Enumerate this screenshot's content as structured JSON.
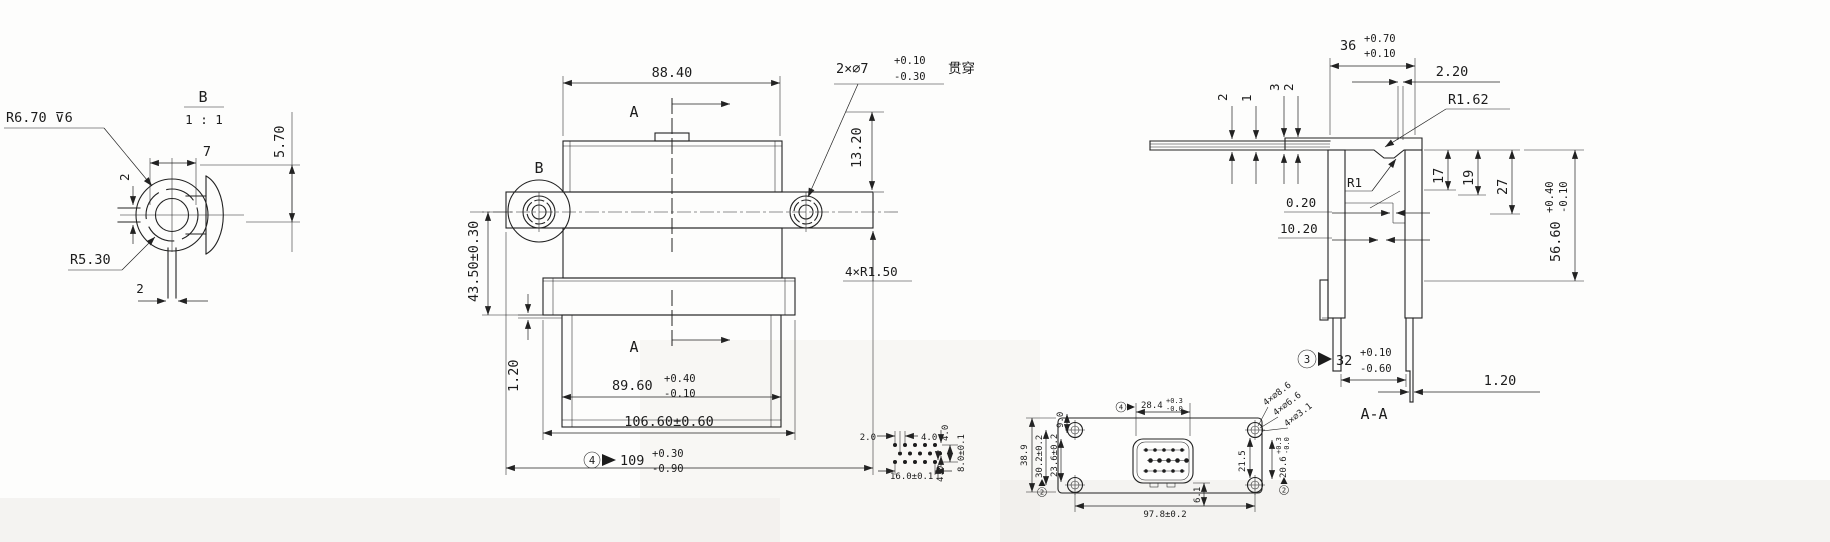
{
  "style": {
    "ink": "#222222",
    "background": "#fdfdfc"
  },
  "detail_b": {
    "title": "B",
    "scale": "1 : 1",
    "dim_width": "7",
    "dim_height": "5.70",
    "callout_radius_depth": "R6.70 ⊽6",
    "dim_slot": "2",
    "callout_radius": "R5.30",
    "dim_stem": "2"
  },
  "front_view": {
    "dim_width_top": "88.40",
    "section_label_top": "A",
    "section_label_bottom": "A",
    "detail_label": "B",
    "hole_callout_base": "2×∅7",
    "hole_callout_plus": "+0.10",
    "hole_callout_minus": "-0.30",
    "hole_callout_note": "贯穿",
    "dim_hole_v": "13.20",
    "dim_left_v": "43.50±0.30",
    "dim_step": "1.20",
    "corner_callout": "4×R1.50",
    "dim_body_base": "89.60",
    "dim_body_plus": "+0.40",
    "dim_body_minus": "-0.10",
    "dim_flange": "106.60±0.60",
    "overall_flag": "4",
    "overall_base": "109",
    "overall_plus": "+0.30",
    "overall_minus": "-0.90"
  },
  "section_aa": {
    "title": "A-A",
    "dim_width_base": "36",
    "dim_width_plus": "+0.70",
    "dim_width_minus": "+0.10",
    "dim_wall_top": "2.20",
    "fillet_outer": "R1.62",
    "fillet_inner": "R1",
    "layers": [
      "2",
      "1",
      "3",
      "2"
    ],
    "dim_step_a": "0.20",
    "dim_step_b": "10.20",
    "depths": [
      "17",
      "19",
      "27"
    ],
    "height_base": "56.60",
    "height_plus": "+0.40",
    "height_minus": "-0.10",
    "opening_flag": "3",
    "opening_base": "32",
    "opening_plus": "+0.10",
    "opening_minus": "-0.60",
    "dim_wall_bottom": "1.20"
  },
  "pin_grid": {
    "dim_offset": "2.0",
    "dim_pitch": "4.0",
    "dim_row_top": "4.0",
    "dim_row_span": "8.0±0.1",
    "dim_row_bottom": "4.0",
    "dim_width": "16.0±0.1"
  },
  "connector_face": {
    "insert_w_flag": "4",
    "insert_w_base": "28.4",
    "insert_w_plus": "+0.3",
    "insert_w_minus": "-0.0",
    "hole_offset_top": "9.0",
    "overall_height": "38.9",
    "holes_v_flag": "2",
    "holes_v": "30.2±0.2",
    "inner_v": "23.6±0.2",
    "hole_callouts": [
      "4×∅8.6",
      "4×∅6.6",
      "4×∅3.1"
    ],
    "right_v": "21.5",
    "insert_h_flag": "2",
    "insert_h_base": "20.6",
    "insert_h_plus": "+0.3",
    "insert_h_minus": "-0.0",
    "holes_h": "97.8±0.2",
    "bottom_offset": "6.1"
  }
}
